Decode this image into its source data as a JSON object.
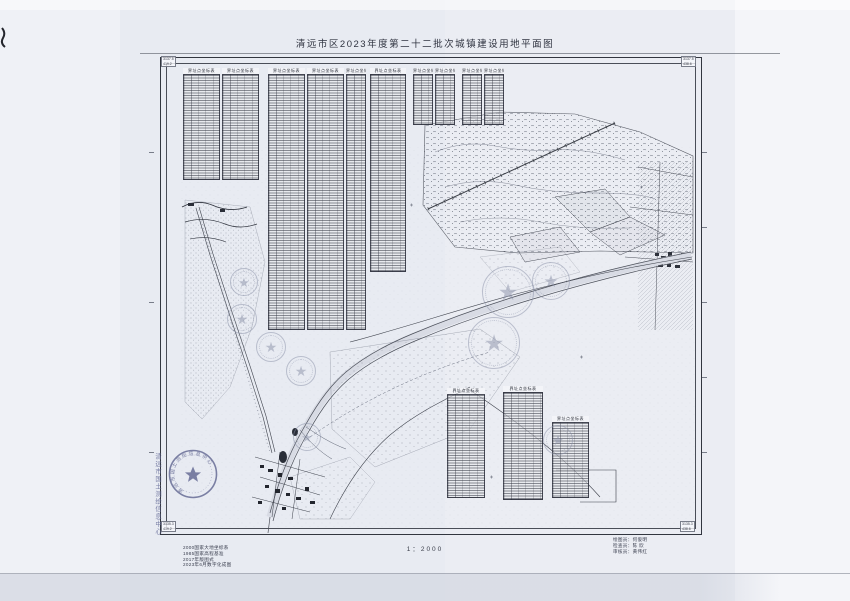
{
  "page": {
    "title": "清远市区2023年度第二十二批次城镇建设用地平面图",
    "scale_label": "1：2000"
  },
  "notes": {
    "lines": [
      "2000国家大地坐标系",
      "1985国家高程基准",
      "2017年版图式",
      "2023年6月数字化成图"
    ]
  },
  "credits": {
    "lines": [
      "绘图员：何俊明",
      "检查员：陈  欣",
      "审核员：黄伟红"
    ]
  },
  "stamp": {
    "agency": "清远市国土测绘信息中心",
    "star": "★"
  },
  "tables": {
    "header": "界址点坐标表",
    "items": [
      {
        "x": 183,
        "y": 68,
        "w": 37,
        "h": 112
      },
      {
        "x": 222,
        "y": 68,
        "w": 37,
        "h": 112
      },
      {
        "x": 268,
        "y": 68,
        "w": 37,
        "h": 262
      },
      {
        "x": 307,
        "y": 68,
        "w": 37,
        "h": 262
      },
      {
        "x": 346,
        "y": 68,
        "w": 20,
        "h": 262
      },
      {
        "x": 370,
        "y": 68,
        "w": 36,
        "h": 204
      },
      {
        "x": 413,
        "y": 68,
        "w": 20,
        "h": 57
      },
      {
        "x": 435,
        "y": 68,
        "w": 20,
        "h": 57
      },
      {
        "x": 462,
        "y": 68,
        "w": 20,
        "h": 57
      },
      {
        "x": 484,
        "y": 68,
        "w": 20,
        "h": 57
      },
      {
        "x": 447,
        "y": 388,
        "w": 38,
        "h": 110
      },
      {
        "x": 503,
        "y": 386,
        "w": 40,
        "h": 114
      },
      {
        "x": 552,
        "y": 416,
        "w": 37,
        "h": 82
      }
    ]
  },
  "seals": {
    "star": "★",
    "items": [
      {
        "x": 244,
        "y": 282,
        "r": 14,
        "tone": "light"
      },
      {
        "x": 242,
        "y": 319,
        "r": 15,
        "tone": "light"
      },
      {
        "x": 271,
        "y": 347,
        "r": 15,
        "tone": "light"
      },
      {
        "x": 301,
        "y": 371,
        "r": 15,
        "tone": "light"
      },
      {
        "x": 508,
        "y": 292,
        "r": 26,
        "tone": "light"
      },
      {
        "x": 551,
        "y": 281,
        "r": 19,
        "tone": "light"
      },
      {
        "x": 494,
        "y": 343,
        "r": 26,
        "tone": "light"
      },
      {
        "x": 307,
        "y": 437,
        "r": 14,
        "tone": "light"
      },
      {
        "x": 558,
        "y": 440,
        "r": 15,
        "tone": "light"
      }
    ]
  },
  "corners": {
    "items": [
      {
        "x": 161,
        "y": 56,
        "lines": [
          "3137.5",
          "419.2"
        ]
      },
      {
        "x": 681,
        "y": 56,
        "lines": [
          "3137.5",
          "438.6"
        ]
      },
      {
        "x": 161,
        "y": 521,
        "lines": [
          "3135.3",
          "419.2"
        ]
      },
      {
        "x": 680,
        "y": 521,
        "lines": [
          "3135.3",
          "438.6"
        ]
      }
    ]
  },
  "ticks": {
    "right": [
      152,
      227,
      302,
      377,
      452
    ],
    "left": [
      152,
      302,
      452
    ]
  }
}
